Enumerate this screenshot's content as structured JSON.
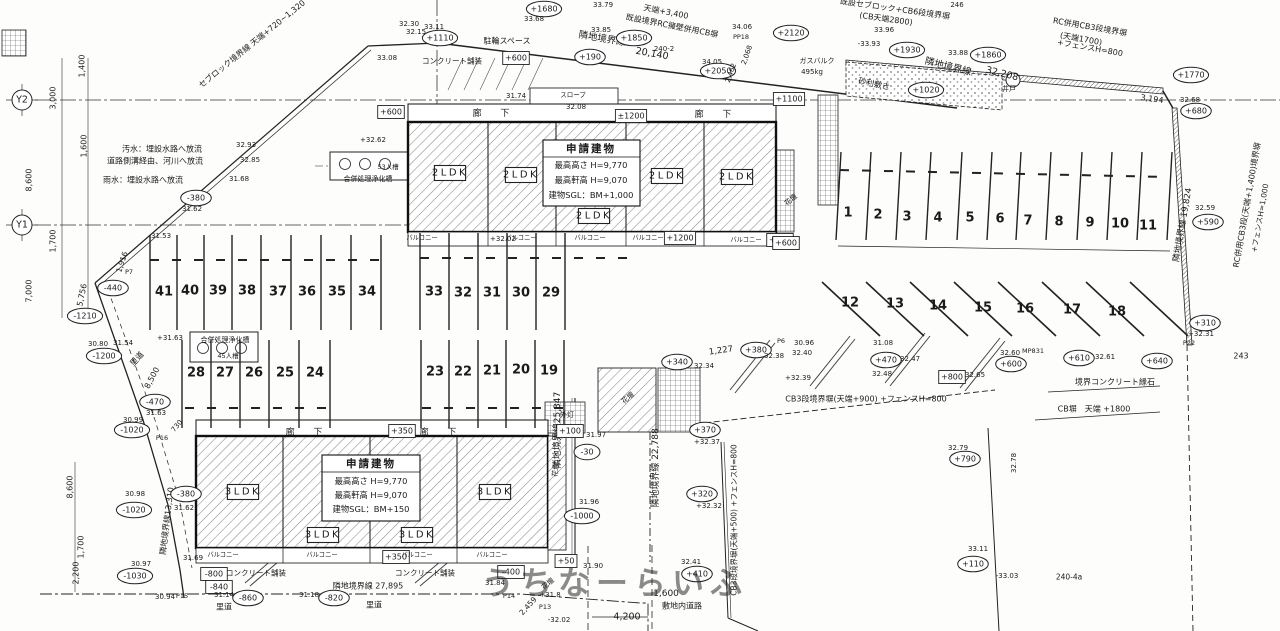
{
  "plan": {
    "watermark": "うちなーらいふ",
    "colors": {
      "parking_number": "#c93ec9",
      "line": "#222222",
      "watermark": "#8f8f8f"
    },
    "buildings": {
      "upper": {
        "title": "申請建物",
        "specs": [
          "最高高さ  H=9,770",
          "最高軒高  H=9,070",
          "建物SGL：BM+1,000"
        ],
        "units": [
          "2LDK",
          "2LDK",
          "2LDK",
          "2LDK",
          "2LDK"
        ],
        "corridor": "廊 下",
        "balcony": "バルコニー"
      },
      "lower": {
        "title": "申請建物",
        "specs": [
          "最高高さ  H=9,770",
          "最高軒高  H=9,070",
          "建物SGL：BM+150"
        ],
        "units": [
          "3LDK",
          "3LDK",
          "3LDK",
          "3LDK"
        ],
        "corridor": "廊 下",
        "balcony": "バルコニー"
      }
    },
    "grid_markers": [
      {
        "t": "Y2",
        "x": 22,
        "y": 100
      },
      {
        "t": "Y1",
        "x": 22,
        "y": 225
      }
    ],
    "parking": {
      "rows": [
        [
          41,
          40,
          39,
          38,
          37,
          36,
          35,
          34
        ],
        [
          33,
          32,
          31,
          30,
          29
        ],
        [
          28,
          27,
          26,
          25,
          24
        ],
        [
          23,
          22,
          21,
          20,
          19
        ],
        [
          1,
          2,
          3,
          4,
          5,
          6,
          7,
          8,
          9,
          10,
          11
        ],
        [
          12,
          13,
          14,
          15,
          16,
          17,
          18
        ]
      ]
    },
    "labels": [
      {
        "t": "セブロック境界線 天端+720~1,320",
        "x": 252,
        "y": 44,
        "r": -39
      },
      {
        "t": "1,400",
        "x": 82,
        "y": 66,
        "r": -90
      },
      {
        "t": "3,000",
        "x": 53,
        "y": 98,
        "r": -90
      },
      {
        "t": "1,600",
        "x": 84,
        "y": 146,
        "r": -90
      },
      {
        "t": "8,600",
        "x": 29,
        "y": 180,
        "r": -90
      },
      {
        "t": "1,700",
        "x": 53,
        "y": 241,
        "r": -90
      },
      {
        "t": "7,000",
        "x": 29,
        "y": 291,
        "r": -90
      },
      {
        "t": "汚水：埋設水路へ放流",
        "x": 162,
        "y": 149
      },
      {
        "t": "道路側溝経由、河川へ放流",
        "x": 155,
        "y": 161
      },
      {
        "t": "雨水：埋設水路へ放流",
        "x": 143,
        "y": 180
      },
      {
        "t": "32.85",
        "x": 250,
        "y": 160,
        "s": 7
      },
      {
        "t": "31.68",
        "x": 239,
        "y": 179,
        "s": 7
      },
      {
        "t": "-380",
        "x": 196,
        "y": 198,
        "k": "o"
      },
      {
        "t": "31.62",
        "x": 192,
        "y": 209,
        "s": 7
      },
      {
        "t": "31.53",
        "x": 161,
        "y": 236,
        "s": 7
      },
      {
        "t": "1,916",
        "x": 122,
        "y": 262,
        "r": -72,
        "s": 7.5
      },
      {
        "t": "P7",
        "x": 129,
        "y": 272,
        "s": 6.5
      },
      {
        "t": "-440",
        "x": 113,
        "y": 288,
        "k": "o"
      },
      {
        "t": "5,756",
        "x": 82,
        "y": 295,
        "r": -78
      },
      {
        "t": "-1210",
        "x": 85,
        "y": 316,
        "k": "o"
      },
      {
        "t": "30.80",
        "x": 98,
        "y": 344,
        "s": 7
      },
      {
        "t": "31.54",
        "x": 123,
        "y": 343,
        "s": 7
      },
      {
        "t": "-1200",
        "x": 104,
        "y": 356,
        "k": "o"
      },
      {
        "t": "里道",
        "x": 137,
        "y": 359,
        "r": -48
      },
      {
        "t": "8,500",
        "x": 152,
        "y": 378,
        "r": -62
      },
      {
        "t": "-470",
        "x": 155,
        "y": 402,
        "k": "o"
      },
      {
        "t": "31.63",
        "x": 156,
        "y": 413,
        "s": 7
      },
      {
        "t": "+31.63",
        "x": 170,
        "y": 338,
        "s": 7
      },
      {
        "t": "30.99",
        "x": 133,
        "y": 420,
        "s": 7
      },
      {
        "t": "-1020",
        "x": 132,
        "y": 430,
        "k": "o"
      },
      {
        "t": "730",
        "x": 177,
        "y": 426,
        "r": -50,
        "s": 7
      },
      {
        "t": "P16",
        "x": 162,
        "y": 438,
        "s": 6.5
      },
      {
        "t": "30.98",
        "x": 135,
        "y": 494,
        "s": 7
      },
      {
        "t": "-1020",
        "x": 134,
        "y": 510,
        "k": "o"
      },
      {
        "t": "隣地境界線13,310",
        "x": 167,
        "y": 521,
        "r": -83,
        "s": 8
      },
      {
        "t": "8,600",
        "x": 70,
        "y": 487,
        "r": -90
      },
      {
        "t": "1,700",
        "x": 81,
        "y": 547,
        "r": -90
      },
      {
        "t": "2,200",
        "x": 76,
        "y": 573,
        "r": -90
      },
      {
        "t": "30.97",
        "x": 141,
        "y": 564,
        "s": 7
      },
      {
        "t": "-1030",
        "x": 135,
        "y": 576,
        "k": "o"
      },
      {
        "t": "30.94",
        "x": 165,
        "y": 597,
        "s": 7
      },
      {
        "t": "P15",
        "x": 182,
        "y": 596,
        "s": 6.5
      },
      {
        "t": "-380",
        "x": 186,
        "y": 494,
        "k": "o"
      },
      {
        "t": "31.62",
        "x": 184,
        "y": 508,
        "s": 7
      },
      {
        "t": "31.69",
        "x": 193,
        "y": 558,
        "s": 7
      },
      {
        "t": "+1680",
        "x": 544,
        "y": 9,
        "k": "o"
      },
      {
        "t": "33.79",
        "x": 603,
        "y": 5,
        "s": 7
      },
      {
        "t": "天端+3,400",
        "x": 666,
        "y": 12,
        "r": 11
      },
      {
        "t": "既設境界RC擁壁併用CB塀",
        "x": 672,
        "y": 26,
        "r": 11
      },
      {
        "t": "隣地境界線",
        "x": 602,
        "y": 39,
        "r": 10,
        "s": 9.5
      },
      {
        "t": "20,140",
        "x": 652,
        "y": 54,
        "r": 10,
        "s": 9.5
      },
      {
        "t": "+1850",
        "x": 634,
        "y": 38,
        "k": "o"
      },
      {
        "t": "33.85",
        "x": 601,
        "y": 30,
        "s": 7
      },
      {
        "t": "+190",
        "x": 590,
        "y": 57,
        "k": "o"
      },
      {
        "t": "240-2",
        "x": 664,
        "y": 49,
        "s": 7
      },
      {
        "t": "駐輪スペース",
        "x": 507,
        "y": 41
      },
      {
        "t": "コンクリート舗装",
        "x": 452,
        "y": 61,
        "s": 7.5
      },
      {
        "t": "+600",
        "x": 516,
        "y": 58,
        "k": "b"
      },
      {
        "t": "+1110",
        "x": 440,
        "y": 38,
        "k": "o"
      },
      {
        "t": "33.11",
        "x": 434,
        "y": 27,
        "s": 7
      },
      {
        "t": "32.30",
        "x": 409,
        "y": 24,
        "s": 7
      },
      {
        "t": "32.15",
        "x": 416,
        "y": 32,
        "s": 7
      },
      {
        "t": "33.68",
        "x": 534,
        "y": 19,
        "s": 7
      },
      {
        "t": "33.08",
        "x": 387,
        "y": 58,
        "s": 7
      },
      {
        "t": "31.74",
        "x": 516,
        "y": 96,
        "s": 7
      },
      {
        "t": "32.08",
        "x": 576,
        "y": 107,
        "s": 7
      },
      {
        "t": "スロープ",
        "x": 573,
        "y": 95,
        "s": 6.5
      },
      {
        "t": "34.06",
        "x": 742,
        "y": 27,
        "s": 7
      },
      {
        "t": "PP18",
        "x": 741,
        "y": 37,
        "s": 6.5
      },
      {
        "t": "34.05",
        "x": 712,
        "y": 62,
        "s": 7
      },
      {
        "t": "+2050",
        "x": 718,
        "y": 71,
        "k": "o"
      },
      {
        "t": "2,462",
        "x": 731,
        "y": 73,
        "r": -70,
        "s": 7
      },
      {
        "t": "2,068",
        "x": 747,
        "y": 55,
        "r": -70,
        "s": 7
      },
      {
        "t": "32.93",
        "x": 246,
        "y": 145,
        "s": 7
      },
      {
        "t": "既設セブロック+CB6段境界塀",
        "x": 895,
        "y": 9,
        "r": 8
      },
      {
        "t": "(CB天端2800)",
        "x": 886,
        "y": 19,
        "r": 8
      },
      {
        "t": "246",
        "x": 957,
        "y": 5,
        "s": 7
      },
      {
        "t": "+2120",
        "x": 791,
        "y": 33,
        "k": "o"
      },
      {
        "t": "33.96",
        "x": 884,
        "y": 30,
        "s": 7
      },
      {
        "t": "-33.93",
        "x": 869,
        "y": 44,
        "s": 7
      },
      {
        "t": "+1930",
        "x": 907,
        "y": 50,
        "k": "o"
      },
      {
        "t": "33.88",
        "x": 958,
        "y": 53,
        "s": 7
      },
      {
        "t": "+1860",
        "x": 988,
        "y": 55,
        "k": "o"
      },
      {
        "t": "隣地境界線",
        "x": 948,
        "y": 67,
        "r": 14,
        "s": 9.5
      },
      {
        "t": "32,208",
        "x": 1002,
        "y": 74,
        "r": 14,
        "s": 9.5
      },
      {
        "t": "砂利敷き",
        "x": 874,
        "y": 84,
        "r": 12
      },
      {
        "t": "+1020",
        "x": 926,
        "y": 90,
        "k": "o"
      },
      {
        "t": "井戸",
        "x": 1009,
        "y": 89,
        "s": 7
      },
      {
        "t": "RC併用CB3段境界塀",
        "x": 1090,
        "y": 27,
        "r": 10
      },
      {
        "t": "(天端1700)",
        "x": 1081,
        "y": 39,
        "r": 10
      },
      {
        "t": "+フェンスH=800",
        "x": 1090,
        "y": 48,
        "r": 10
      },
      {
        "t": "ガスバルク",
        "x": 817,
        "y": 61,
        "s": 7
      },
      {
        "t": "495kg",
        "x": 812,
        "y": 72,
        "s": 7
      },
      {
        "t": "+1100",
        "x": 789,
        "y": 99,
        "k": "b"
      },
      {
        "t": "3,194",
        "x": 1152,
        "y": 99,
        "r": 8
      },
      {
        "t": "+1770",
        "x": 1191,
        "y": 75,
        "k": "o"
      },
      {
        "t": "32.68",
        "x": 1190,
        "y": 100,
        "s": 7
      },
      {
        "t": "+680",
        "x": 1196,
        "y": 111,
        "k": "o"
      },
      {
        "t": "花壇",
        "x": 791,
        "y": 200,
        "r": -40,
        "s": 7
      },
      {
        "t": "+600",
        "x": 780,
        "y": 240,
        "k": "b"
      },
      {
        "t": "隣地境界線 19,824",
        "x": 1183,
        "y": 225,
        "r": -80,
        "s": 8.5
      },
      {
        "t": "32.59",
        "x": 1205,
        "y": 208,
        "s": 7
      },
      {
        "t": "+590",
        "x": 1208,
        "y": 222,
        "k": "o"
      },
      {
        "t": "RC併用CB3段(天端+1,400)境界塀",
        "x": 1247,
        "y": 205,
        "r": -80,
        "s": 8
      },
      {
        "t": "+フェンスH=1,000",
        "x": 1260,
        "y": 218,
        "r": -80,
        "s": 7.5
      },
      {
        "t": "+310",
        "x": 1205,
        "y": 323,
        "k": "o"
      },
      {
        "t": "+32.31",
        "x": 1201,
        "y": 334,
        "s": 7
      },
      {
        "t": "P22",
        "x": 1189,
        "y": 343,
        "s": 6.5
      },
      {
        "t": "243",
        "x": 1241,
        "y": 356
      },
      {
        "t": "+640",
        "x": 1157,
        "y": 361,
        "k": "o"
      },
      {
        "t": "+610",
        "x": 1079,
        "y": 358,
        "k": "o"
      },
      {
        "t": "32.61",
        "x": 1105,
        "y": 357,
        "s": 7
      },
      {
        "t": "+600",
        "x": 1011,
        "y": 364,
        "k": "o"
      },
      {
        "t": "32.60",
        "x": 1010,
        "y": 353,
        "s": 7
      },
      {
        "t": "MP831",
        "x": 1033,
        "y": 351,
        "s": 6.5
      },
      {
        "t": "境界コンクリート縁石",
        "x": 1115,
        "y": 382
      },
      {
        "t": "CB塀　天端 +1800",
        "x": 1094,
        "y": 409
      },
      {
        "t": "32.78",
        "x": 1014,
        "y": 463,
        "r": -90,
        "s": 7
      },
      {
        "t": "+340",
        "x": 677,
        "y": 362,
        "k": "o"
      },
      {
        "t": "1,227",
        "x": 721,
        "y": 351,
        "r": -8,
        "s": 8.5
      },
      {
        "t": "32.34",
        "x": 704,
        "y": 366,
        "s": 7
      },
      {
        "t": "+380",
        "x": 756,
        "y": 350,
        "k": "o"
      },
      {
        "t": "32.38",
        "x": 774,
        "y": 356,
        "s": 7
      },
      {
        "t": "32.40",
        "x": 802,
        "y": 353,
        "s": 7
      },
      {
        "t": "P6",
        "x": 781,
        "y": 341,
        "s": 6.5
      },
      {
        "t": "30.96",
        "x": 804,
        "y": 343,
        "s": 7
      },
      {
        "t": "+32.39",
        "x": 798,
        "y": 378,
        "s": 7
      },
      {
        "t": "+470",
        "x": 886,
        "y": 360,
        "k": "o"
      },
      {
        "t": "31.08",
        "x": 883,
        "y": 343,
        "s": 7
      },
      {
        "t": "32.47",
        "x": 910,
        "y": 359,
        "s": 7
      },
      {
        "t": "32.48",
        "x": 882,
        "y": 374,
        "s": 7
      },
      {
        "t": "+800",
        "x": 952,
        "y": 377,
        "k": "b"
      },
      {
        "t": "32.65",
        "x": 975,
        "y": 375,
        "s": 7
      },
      {
        "t": "CB3段境界塀(天端+900) +フェンスH=800",
        "x": 866,
        "y": 399
      },
      {
        "t": "隣地境界線 22,788",
        "x": 656,
        "y": 468,
        "r": -90,
        "s": 9
      },
      {
        "t": "+370",
        "x": 705,
        "y": 430,
        "k": "o"
      },
      {
        "t": "+32.37",
        "x": 707,
        "y": 442,
        "s": 7
      },
      {
        "t": "+790",
        "x": 965,
        "y": 459,
        "k": "o"
      },
      {
        "t": "32.79",
        "x": 958,
        "y": 448,
        "s": 7
      },
      {
        "t": "隣地境界線25,347",
        "x": 558,
        "y": 430,
        "r": -90,
        "s": 9
      },
      {
        "t": "CB3段境界塀(天端+500) +フェンスH=800",
        "x": 734,
        "y": 520,
        "r": -90,
        "s": 7.5
      },
      {
        "t": "+320",
        "x": 702,
        "y": 494,
        "k": "o"
      },
      {
        "t": "+32.32",
        "x": 709,
        "y": 506,
        "s": 7
      },
      {
        "t": "32.41",
        "x": 691,
        "y": 562,
        "s": 7
      },
      {
        "t": "+410",
        "x": 697,
        "y": 574,
        "k": "o"
      },
      {
        "t": "1,600",
        "x": 666,
        "y": 594,
        "s": 9
      },
      {
        "t": "敷地内道路",
        "x": 682,
        "y": 606
      },
      {
        "t": "33.11",
        "x": 978,
        "y": 549,
        "s": 7
      },
      {
        "t": "+110",
        "x": 973,
        "y": 564,
        "k": "o"
      },
      {
        "t": "-33.03",
        "x": 1007,
        "y": 576,
        "s": 7
      },
      {
        "t": "240-4a",
        "x": 1069,
        "y": 577,
        "s": 7.5
      },
      {
        "t": "4,200",
        "x": 627,
        "y": 617,
        "s": 9.5
      },
      {
        "t": "+50",
        "x": 566,
        "y": 561,
        "k": "b"
      },
      {
        "t": "-400",
        "x": 511,
        "y": 572,
        "k": "b"
      },
      {
        "t": "31.84",
        "x": 495,
        "y": 583,
        "s": 7
      },
      {
        "t": "31.90",
        "x": 593,
        "y": 566,
        "s": 7
      },
      {
        "t": "花壇",
        "x": 548,
        "y": 584,
        "r": -40,
        "s": 7
      },
      {
        "t": "+31.8",
        "x": 550,
        "y": 595,
        "s": 7
      },
      {
        "t": "P14",
        "x": 509,
        "y": 596,
        "s": 6.5
      },
      {
        "t": "2,459",
        "x": 528,
        "y": 606,
        "r": -48,
        "s": 7.5
      },
      {
        "t": "P13",
        "x": 545,
        "y": 607,
        "s": 6.5
      },
      {
        "t": "-32.02",
        "x": 559,
        "y": 620,
        "s": 7
      },
      {
        "t": "隣地境界線 27,895",
        "x": 368,
        "y": 586
      },
      {
        "t": "31.18",
        "x": 309,
        "y": 595,
        "s": 7
      },
      {
        "t": "-820",
        "x": 334,
        "y": 598,
        "k": "o"
      },
      {
        "t": "里道",
        "x": 374,
        "y": 605
      },
      {
        "t": "-800",
        "x": 214,
        "y": 574,
        "k": "b"
      },
      {
        "t": "-840",
        "x": 219,
        "y": 587,
        "k": "b"
      },
      {
        "t": "31.14",
        "x": 224,
        "y": 595,
        "s": 7
      },
      {
        "t": "-860",
        "x": 248,
        "y": 598,
        "k": "o"
      },
      {
        "t": "里道",
        "x": 224,
        "y": 607
      },
      {
        "t": "コンクリート舗装",
        "x": 256,
        "y": 573,
        "s": 7.5
      },
      {
        "t": "コンクリート舗装",
        "x": 425,
        "y": 573,
        "s": 7.5
      },
      {
        "t": "+350",
        "x": 402,
        "y": 431,
        "k": "b"
      },
      {
        "t": "外灯",
        "x": 567,
        "y": 415,
        "s": 7
      },
      {
        "t": "+100",
        "x": 570,
        "y": 431,
        "k": "b"
      },
      {
        "t": "31.97",
        "x": 596,
        "y": 435,
        "s": 7
      },
      {
        "t": "-30",
        "x": 587,
        "y": 452,
        "k": "o"
      },
      {
        "t": "花壇",
        "x": 556,
        "y": 470,
        "r": -80,
        "s": 7
      },
      {
        "t": "31.96",
        "x": 589,
        "y": 502,
        "s": 7
      },
      {
        "t": "-1000",
        "x": 582,
        "y": 516,
        "k": "o"
      },
      {
        "t": "+350",
        "x": 396,
        "y": 557,
        "k": "b"
      },
      {
        "t": "+32.62",
        "x": 373,
        "y": 140,
        "s": 7
      },
      {
        "t": "53人槽",
        "x": 388,
        "y": 167,
        "s": 6.5
      },
      {
        "t": "合併処理浄化槽",
        "x": 368,
        "y": 179,
        "s": 7
      },
      {
        "t": "合併処理浄化槽",
        "x": 225,
        "y": 340,
        "s": 7
      },
      {
        "t": "45人槽",
        "x": 228,
        "y": 356,
        "s": 6.5
      },
      {
        "t": "±1200",
        "x": 631,
        "y": 116,
        "k": "b"
      },
      {
        "t": "+600",
        "x": 391,
        "y": 112,
        "k": "b"
      },
      {
        "t": "+32.02",
        "x": 503,
        "y": 239,
        "s": 7
      },
      {
        "t": "+1200",
        "x": 680,
        "y": 238,
        "k": "b"
      },
      {
        "t": "+600",
        "x": 786,
        "y": 243,
        "k": "b"
      },
      {
        "t": "花壇",
        "x": 628,
        "y": 398,
        "r": -40,
        "s": 7
      }
    ]
  }
}
